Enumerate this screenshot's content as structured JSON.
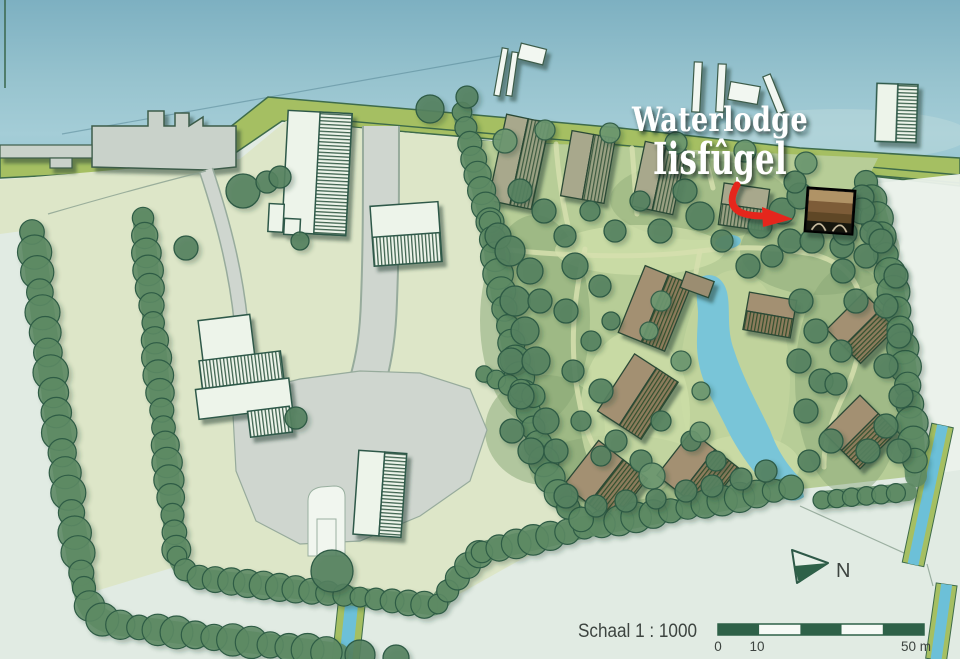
{
  "map": {
    "title": {
      "line1": "Waterlodge",
      "line2": "Iisfûgel"
    },
    "north_label": "N",
    "scalebar": {
      "label": "Schaal 1 : 1000",
      "ticks": [
        "0",
        "10",
        "50 m"
      ]
    },
    "colors": {
      "water": "#8fc0cc",
      "dike_shore": "#a5bf62",
      "farm_field": "#dde6c8",
      "pale_meadow": "#e1ebe3",
      "park_green": "#b7cd97",
      "hedge": "#5d8a64",
      "tree": "#55825f",
      "road": "#cfd6cf",
      "building_outline": "#2e5948",
      "lodge_roof": "#8d7c5c",
      "pond": "#79c5d8",
      "highlight_arrow_red": "#e5261d",
      "title_text": "#ffffff",
      "label_text": "#3d4440"
    }
  }
}
